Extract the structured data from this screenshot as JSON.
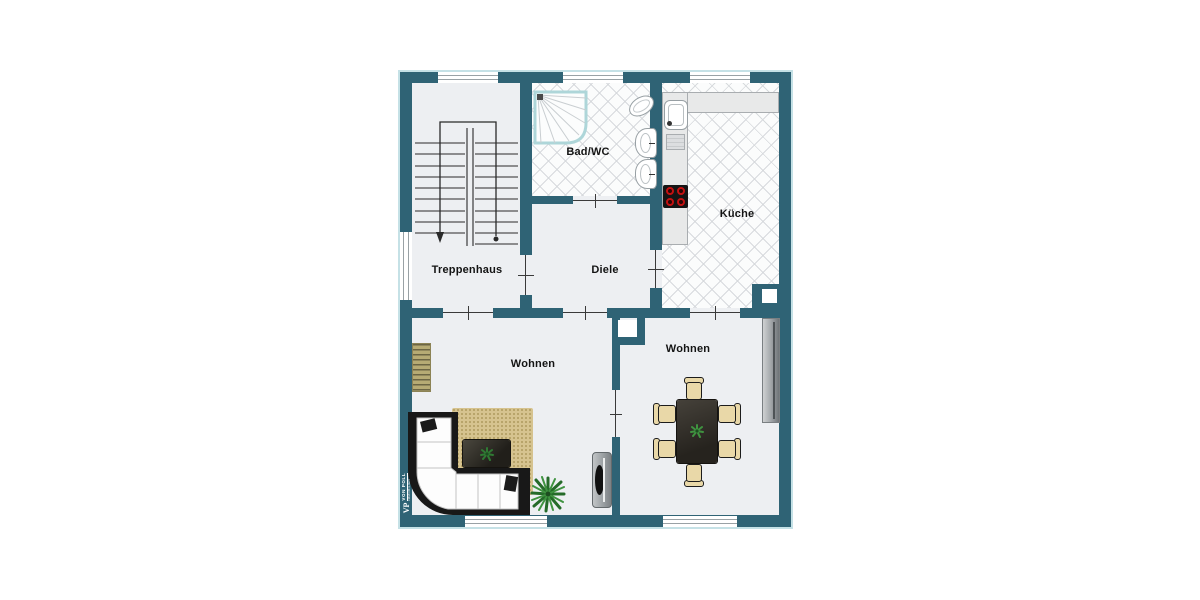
{
  "watermark": {
    "monogram": "VP",
    "brand": "VON POLL",
    "brand_sub": "IMMOBILIEN"
  },
  "rooms": [
    {
      "label": "Treppenhaus"
    },
    {
      "label": "Bad/WC"
    },
    {
      "label": "Küche"
    },
    {
      "label": "Diele"
    },
    {
      "label": "Wohnen"
    },
    {
      "label": "Wohnen"
    }
  ],
  "colors": {
    "wall": "#2f6375",
    "floor": "#edeff2",
    "tile_floor": "#fbfcfc",
    "tile_line": "#d7dadd",
    "rug": "#d6c38f",
    "chair_wood": "#e9d8a8",
    "table_dark": "#26231e",
    "plant_green": "#2f7a33",
    "burner_red": "#c41111",
    "counter": "#e8e9e9",
    "window_line": "#99a1a5"
  },
  "furniture_icons": [
    "staircase-icon",
    "shower-icon",
    "toilet-icon",
    "washbasin-icon",
    "washbasin-icon",
    "kitchen-sink-icon",
    "stove-icon",
    "kitchen-counter-icon",
    "sideboard-icon",
    "corner-sofa-icon",
    "rug-icon",
    "coffee-table-icon",
    "floor-plant-icon",
    "tv-lowboard-icon",
    "dining-table-icon",
    "dining-chair-icon",
    "radiator-icon",
    "shaft-icon"
  ]
}
